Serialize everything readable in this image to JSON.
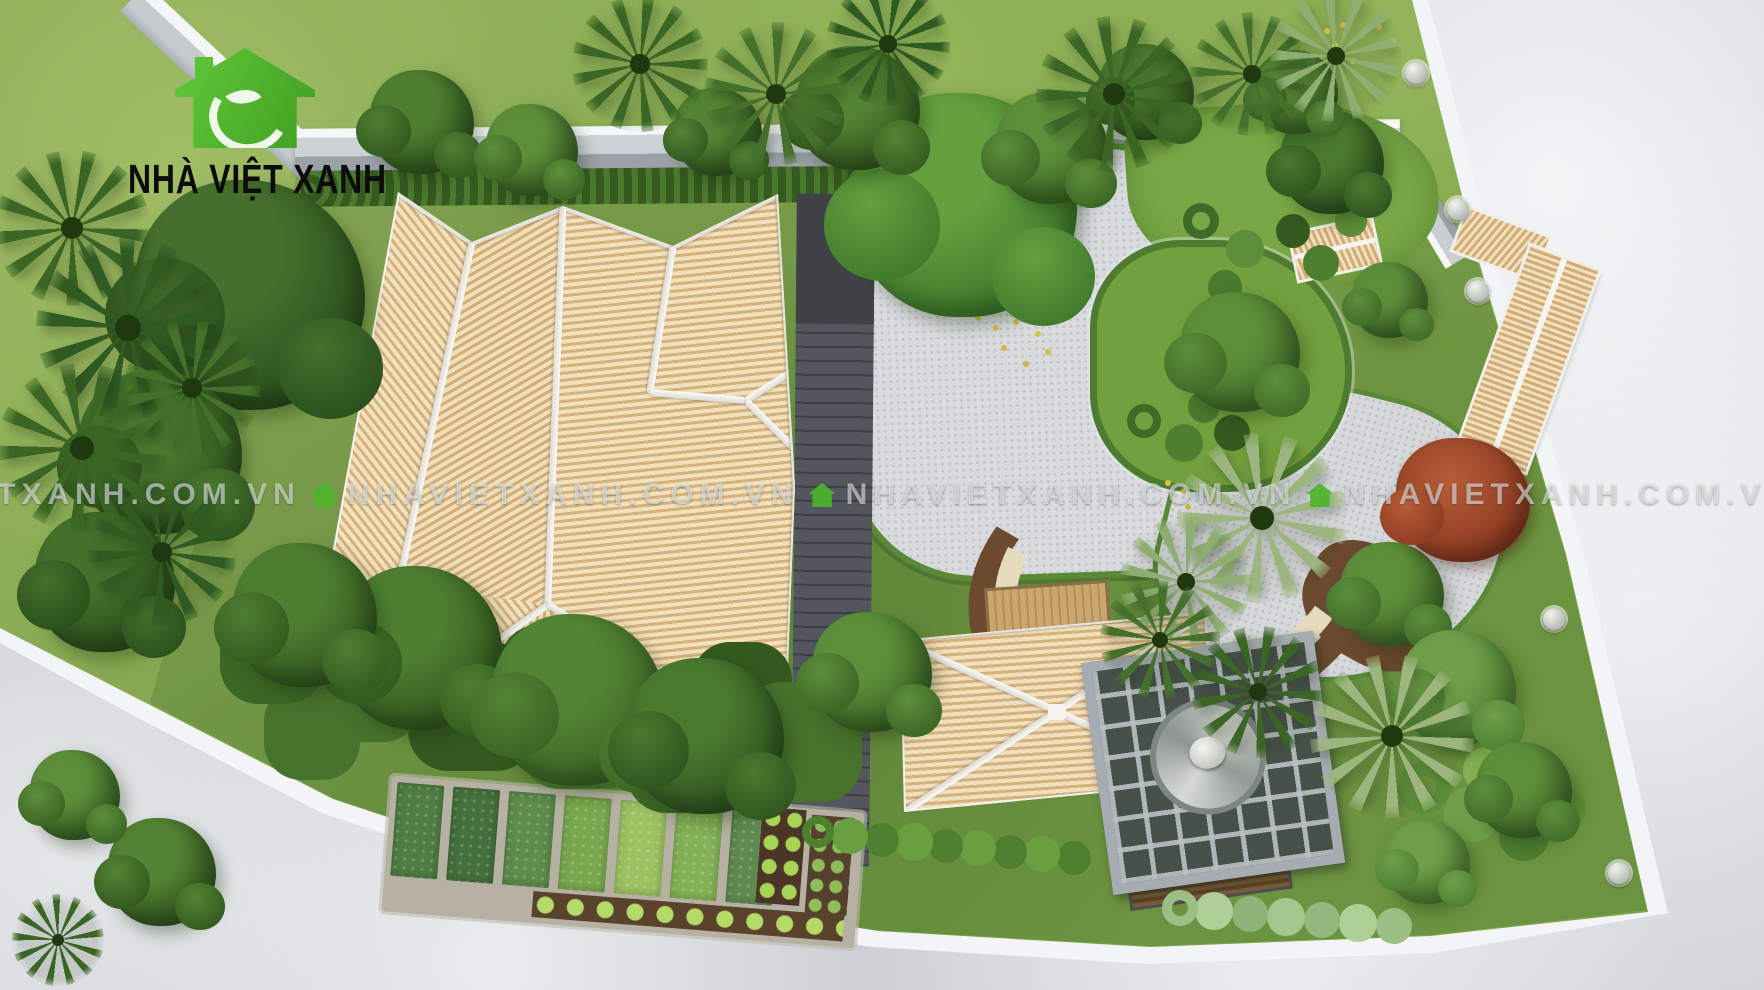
{
  "image": {
    "type": "3d-aerial-architectural-render",
    "subject": "Top-down rendering of a garden villa compound with tiled hip roofs, courtyards, vegetable garden and perimeter wall"
  },
  "logo": {
    "text": "NHÀ VIỆT XANH",
    "icon": "green-house-with-leaf-icon",
    "icon_color": "#4db32c",
    "text_color": "#0c0c0c"
  },
  "watermark": {
    "text": "NHAVIETXANH.COM.VN",
    "separator_icon": "green-house-icon",
    "icon_color": "#4db32c",
    "text_color": "#f6f8fa",
    "opacity": 0.55,
    "repeats_visible": 4
  },
  "palette": {
    "road": "#ccd0d4",
    "outer_lawn": "#7da34b",
    "inner_lawn": "#6d9a3f",
    "tree_dark": "#33591f",
    "tree_mid": "#4a7a2e",
    "tree_light": "#7fae52",
    "palm_dark": "#3a6524",
    "palm_light": "#9db57e",
    "roof_tile": "#d7b17a",
    "roof_tile_light": "#f1e2c0",
    "roof_ridge": "#f6f4ef",
    "perimeter_wall": "#f3f4f6",
    "courtyard_cobble": "#d8dadc",
    "dark_walkway": "#53575d",
    "pergola_frame": "#a6acb1",
    "soil_path": "#6b4a2f",
    "flagstone": "#e6dcbd",
    "wood_deck": "#caa76e",
    "red_tree": "#9a4226",
    "vegetable_bed_greens": [
      "#4f7d43",
      "#44703c",
      "#5e8c4b",
      "#79a84e",
      "#9dc262",
      "#84b257",
      "#5f8a4f"
    ]
  },
  "scene": {
    "view": "top-down aerial",
    "areas": [
      "outer lawn",
      "concrete road",
      "perimeter wall",
      "main house tiled hip roof",
      "garden pavilion hip roof",
      "cobblestone courtyard",
      "curved garden path",
      "grass island",
      "stone-and-soil koi path",
      "wooden deck bridge",
      "vine-covered walkway",
      "bamboo fence",
      "vegetable garden beds",
      "cabbage rows",
      "seating pergola with stone mosaic and swing chair",
      "entrance gate tiled roof",
      "side gate roof",
      "palm trees",
      "ornamental trees",
      "red maple tree",
      "stone urns on wall posts"
    ]
  }
}
